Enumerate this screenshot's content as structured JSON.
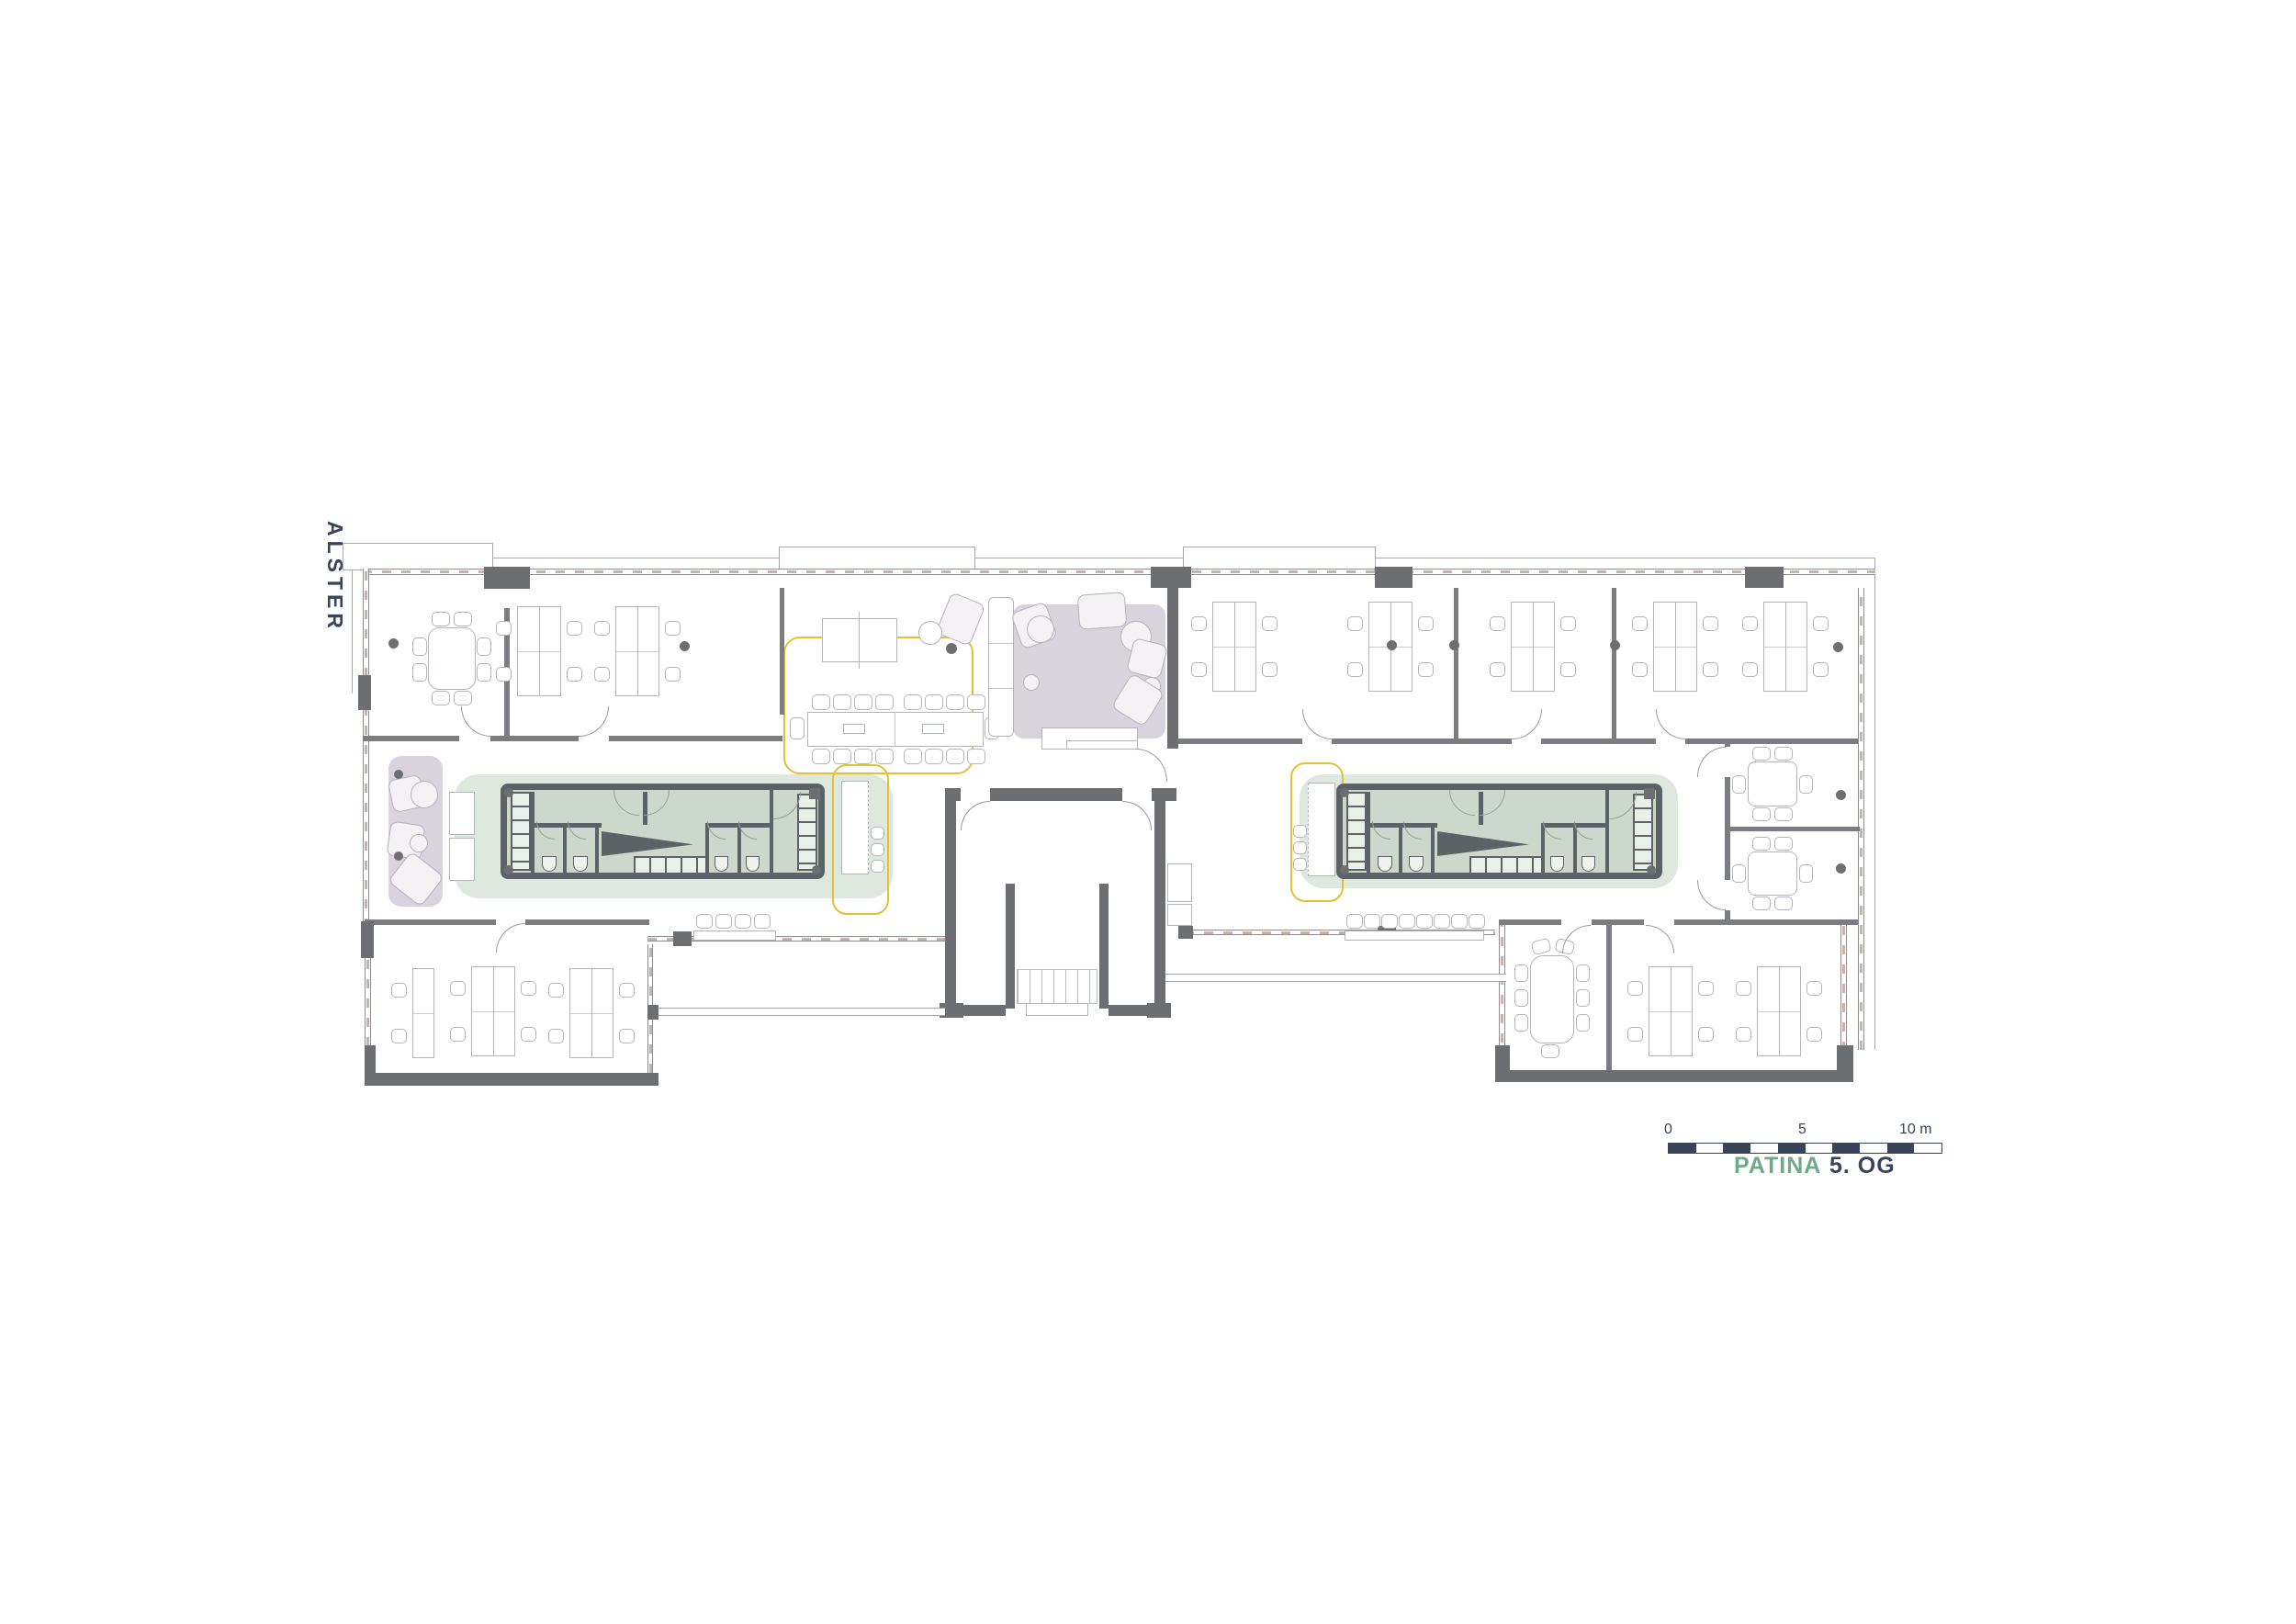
{
  "title": "PATINA 5. OG office floor plan",
  "labels": {
    "water": "ALSTER"
  },
  "legend": {
    "project": "PATINA",
    "floor": "5. OG"
  },
  "scale_bar": {
    "tick_0": "0",
    "tick_5": "5",
    "tick_10": "10 m",
    "segments": 10
  },
  "colors": {
    "wall": "#6d6e71",
    "wall_line": "#7c7d80",
    "line_light": "#9a9b9e",
    "furniture_line": "#b2b5b9",
    "glazing_dash": "#c9b2a8",
    "zone_green": "#dfe8df",
    "core_fill": "#ccd8cb",
    "core_wall": "#5b6366",
    "zone_purple": "#d9d3dd",
    "furniture_fill_soft": "#f4f2f5",
    "highlight_yellow": "#e2c233",
    "text_navy": "#3a4459",
    "text_green": "#6fa98c"
  }
}
